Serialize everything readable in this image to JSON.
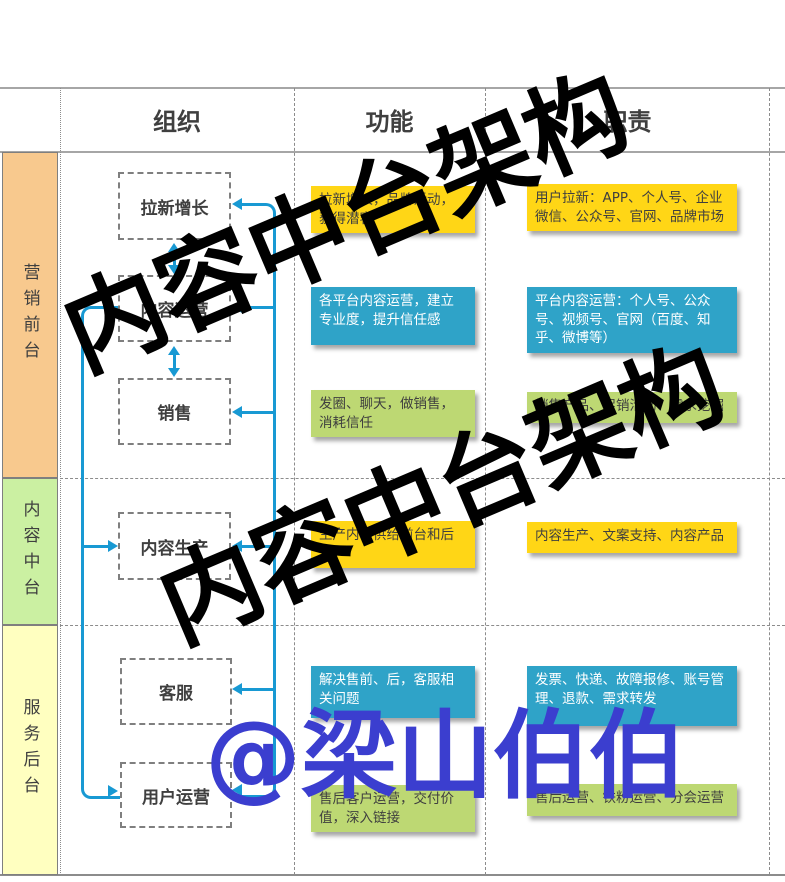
{
  "header": {
    "col_org": "组织",
    "col_function": "功能",
    "col_duty": "职责"
  },
  "sidebar": [
    {
      "label": "营销前台",
      "color": "#F8C98E"
    },
    {
      "label": "内容中台",
      "color": "#CBF0A2"
    },
    {
      "label": "服务后台",
      "color": "#FFFFC0"
    }
  ],
  "rows": [
    {
      "org": "拉新增长",
      "function": "拉新增长，品牌活动，获得潜客",
      "duty": "用户拉新：APP、个人号、企业微信、公众号、官网、品牌市场",
      "color": "#FFD616"
    },
    {
      "org": "内容运营",
      "function": "各平台内容运营，建立专业度，提升信任感",
      "duty": "平台内容运营：个人号、公众号、视频号、官网（百度、知乎、微博等）",
      "color": "#2FA3C8"
    },
    {
      "org": "销售",
      "function": "发圈、聊天，做销售，消耗信任",
      "duty": "销售产品、促销活动、需求挖掘",
      "color": "#BDD873"
    },
    {
      "org": "内容生产",
      "function": "生产内容供给前台和后台",
      "duty": "内容生产、文案支持、内容产品",
      "color": "#FFD616"
    },
    {
      "org": "客服",
      "function": "解决售前、后，客服相关问题",
      "duty": "发票、快递、故障报修、账号管理、退款、需求转发",
      "color": "#2FA3C8"
    },
    {
      "org": "用户运营",
      "function": "售后客户运营，交付价值，深入链接",
      "duty": "售后运营、铁粉运营、分会运营",
      "color": "#BDD873"
    }
  ],
  "watermark": {
    "text": "内容中台架构",
    "handle": "@梁山伯伯",
    "text_color": "#000000",
    "handle_color": "#3B3ECF"
  },
  "palette": {
    "arrow_blue": "#1899D3",
    "box_yellow": "#FFD616",
    "box_blue": "#2FA3C8",
    "box_green": "#BDD873",
    "sidebar_orange": "#F8C98E",
    "sidebar_green": "#CBF0A2",
    "sidebar_yellow": "#FFFFC0"
  }
}
